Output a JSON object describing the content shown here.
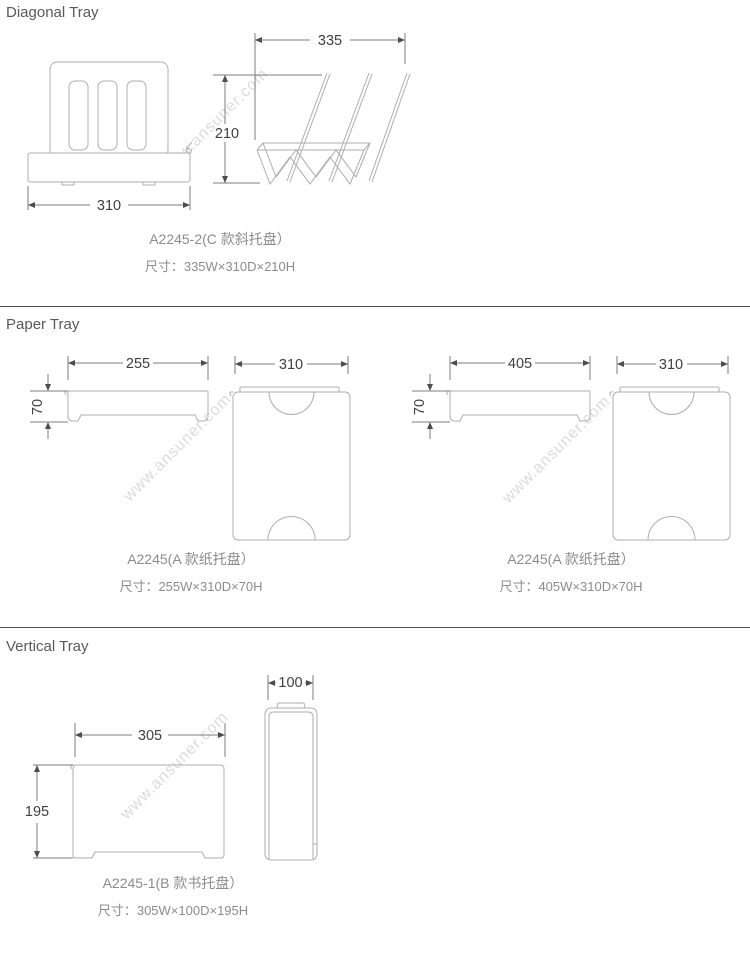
{
  "watermark": {
    "text": "www.ansuner.com"
  },
  "sections": {
    "diagonal": {
      "heading": "Diagonal Tray",
      "front": {
        "width_dim": "310"
      },
      "side": {
        "width_dim": "335",
        "height_dim": "210"
      },
      "label": {
        "model": "A2245-2(C 款斜托盘）",
        "size": "尺寸：335W×310D×210H"
      }
    },
    "paper": {
      "heading": "Paper Tray",
      "left": {
        "side": {
          "width_dim": "255",
          "height_dim": "70"
        },
        "top": {
          "width_dim": "310"
        },
        "label": {
          "model": "A2245(A 款纸托盘）",
          "size": "尺寸：255W×310D×70H"
        }
      },
      "right": {
        "side": {
          "width_dim": "405",
          "height_dim": "70"
        },
        "top": {
          "width_dim": "310"
        },
        "label": {
          "model": "A2245(A 款纸托盘）",
          "size": "尺寸：405W×310D×70H"
        }
      }
    },
    "vertical": {
      "heading": "Vertical Tray",
      "side": {
        "width_dim": "305",
        "height_dim": "195"
      },
      "front": {
        "width_dim": "100"
      },
      "label": {
        "model": "A2245-1(B 款书托盘）",
        "size": "尺寸：305W×100D×195H"
      }
    }
  },
  "colors": {
    "heading_text": "#595959",
    "label_text": "#8c8c8c",
    "dimension_text": "#3f3f3f",
    "drawing_line": "#aeaeae",
    "dimension_line": "#7d7d7d",
    "divider": "#4f4f4f",
    "watermark": "#dbdbdb"
  }
}
